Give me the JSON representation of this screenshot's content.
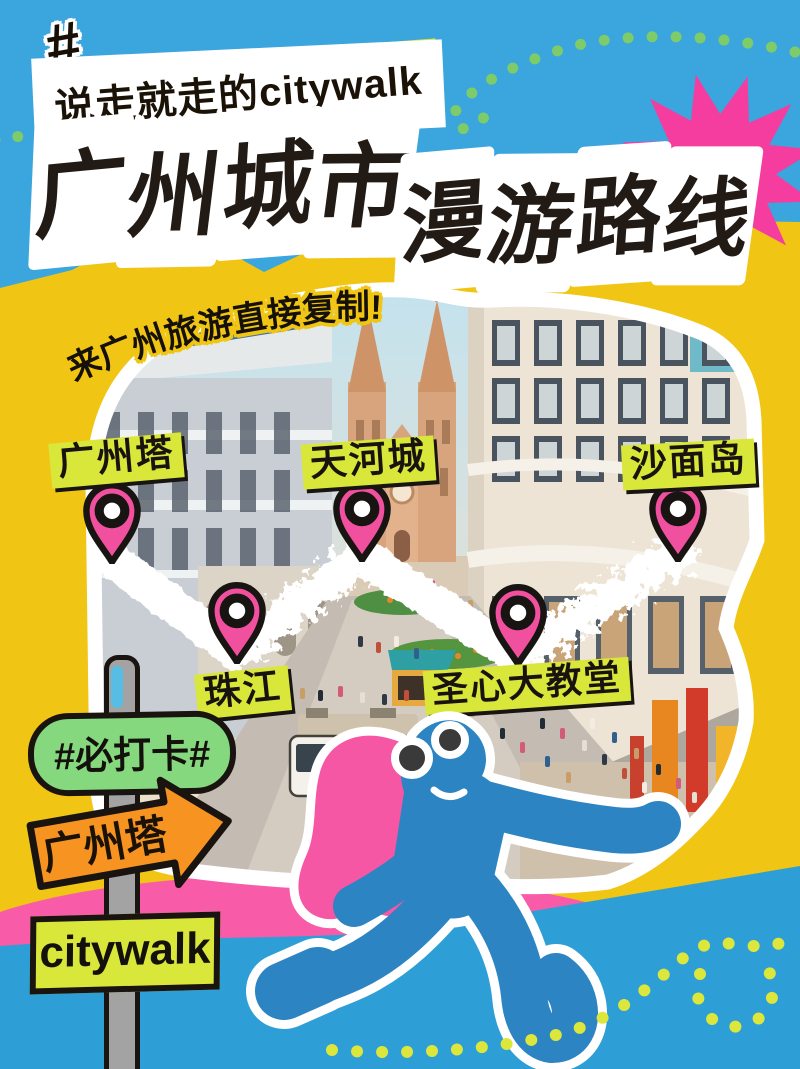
{
  "poster": {
    "header": {
      "hash": "#",
      "tagline": "说走就走的citywalk",
      "title_line1": "广州城市",
      "title_line2": "漫游路线"
    },
    "photo": {
      "note": "来广州旅游直接复制!",
      "bus_text": "警察 POLICE"
    },
    "map_pins": [
      {
        "name": "广州塔"
      },
      {
        "name": "珠江"
      },
      {
        "name": "天河城"
      },
      {
        "name": "圣心大教堂"
      },
      {
        "name": "沙面岛"
      }
    ],
    "signpost": {
      "badge": "#必打卡#",
      "arrow_sign": "广州塔",
      "bottom_sign": "citywalk"
    },
    "colors": {
      "sky_blue": "#3BA5DE",
      "golden_yellow": "#F0C514",
      "lime": "#D9E63A",
      "dot_green": "#7ECB6A",
      "hot_pink": "#F0509E",
      "starburst_pink": "#F53DA0",
      "band_pink": "#F85CA9",
      "badge_green": "#85D87E",
      "arrow_orange": "#F79421",
      "character_blue": "#2C84C2",
      "bottom_blue": "#2E9FD6",
      "ink_black": "#1A1410"
    }
  }
}
